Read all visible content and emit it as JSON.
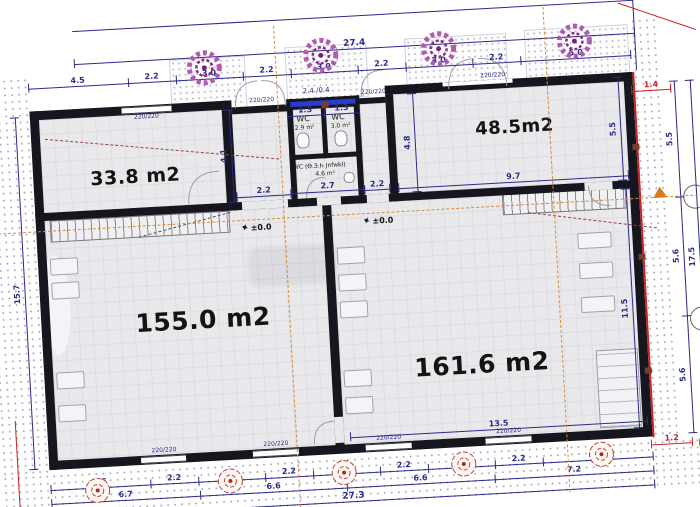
{
  "colors": {
    "wall": "#16161e",
    "dim_line": "#2b2b8a",
    "axis_orange": "#d98a3c",
    "red": "#cc2222",
    "tree": "#a43ba0",
    "rose": "#b34a33"
  },
  "rooms": {
    "top_left": "33.8 m2",
    "top_right": "48.5m2",
    "main_left": "155.0  m2",
    "main_right": "161.6 m2"
  },
  "wc": {
    "left_label": "WC",
    "left_area": "2.9 m²",
    "right_label": "WC",
    "right_area": "3.0 m²",
    "lobby_label": "WC (Ө.З.Һ Jnfwkl)",
    "lobby_area": "4.6 m²",
    "note_above": "2.4 /0.4"
  },
  "levels": {
    "left": "±0.0",
    "right": "±0.0"
  },
  "windows": {
    "size_label": "220/220"
  },
  "dims": {
    "top_total": "27.4",
    "top_segments": [
      "4.5",
      "2.2",
      "3.0",
      "2.2",
      "3.0",
      "2.2",
      "3.0",
      "2.2",
      "5.0"
    ],
    "bottom_segments": [
      "4.5",
      "2.2",
      "3.0",
      "2.2",
      "3.0",
      "2.2",
      "3.0",
      "2.2",
      "5.0"
    ],
    "bottom_groups": [
      "6.7",
      "6.6",
      "6.6",
      "7.2"
    ],
    "bottom_total": "27.3",
    "left_total": "15.7",
    "right_segments": [
      "5.5",
      "5.6",
      "5.6"
    ],
    "right_total": "17.5",
    "room33_height": "4.1",
    "room48_left_height": "4.8",
    "room48_right_height": "5.5",
    "room161_height": "11.5",
    "room161_top_width": "9.7",
    "entry_left_width": "2.2",
    "entry_right_width": "2.2",
    "room161_bottom_width": "13.5",
    "wc_stall_left": "1.3",
    "wc_stall_right": "1.3",
    "wc_width": "2.7",
    "offset_top_right": "1.4",
    "offset_bottom_right": "1.2"
  }
}
